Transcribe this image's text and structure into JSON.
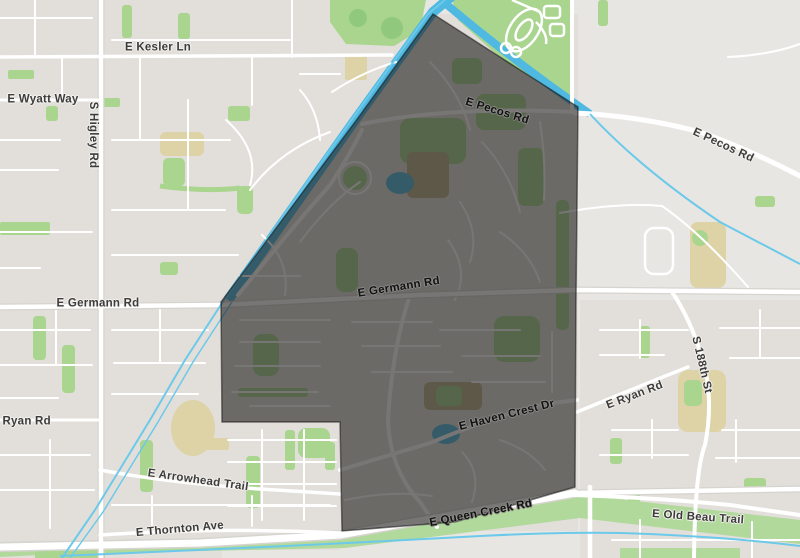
{
  "map": {
    "description": "Street map with a dark highlighted neighborhood boundary region",
    "colors": {
      "land": "#e8e6e2",
      "block": "#e2dfda",
      "road": "#ffffff",
      "road_casing": "#d6d4cf",
      "park_green": "#a9d58f",
      "park_green_dark": "#90c97e",
      "corridor_green": "#b0d99b",
      "water_blue": "#5ec3e9",
      "channel_blue": "#4fb9e2",
      "tan": "#ddd3a6",
      "label_outside": "#3c3c3c",
      "label_inside": "#121212"
    },
    "highlight_region": {
      "name": "selected neighborhood boundary",
      "polygon_px": "433,14 578,107 576,300 575,487 455,522 342,531 340,422 222,422 221,302 358,118",
      "fill": "rgba(35,34,33,0.62)",
      "stroke": "rgba(10,10,10,0.5)"
    },
    "road_labels": [
      {
        "text": "E Kesler Ln",
        "x": 158,
        "y": 48,
        "rot": 0,
        "style": "outside"
      },
      {
        "text": "E Wyatt Way",
        "x": 43,
        "y": 100,
        "rot": 0,
        "style": "outside"
      },
      {
        "text": "S Higley Rd",
        "x": 92,
        "y": 135,
        "rot": 90,
        "style": "outside"
      },
      {
        "text": "E Pecos Rd",
        "x": 497,
        "y": 112,
        "rot": 17,
        "style": "inside"
      },
      {
        "text": "E Pecos Rd",
        "x": 723,
        "y": 146,
        "rot": 25,
        "style": "outside"
      },
      {
        "text": "E Germann Rd",
        "x": 98,
        "y": 304,
        "rot": 0,
        "style": "outside"
      },
      {
        "text": "E Germann Rd",
        "x": 399,
        "y": 288,
        "rot": -9,
        "style": "inside"
      },
      {
        "text": "S 188th St",
        "x": 701,
        "y": 365,
        "rot": 77,
        "style": "outside"
      },
      {
        "text": "E Ryan Rd",
        "x": 21,
        "y": 422,
        "rot": 0,
        "style": "outside"
      },
      {
        "text": "E Ryan Rd",
        "x": 635,
        "y": 396,
        "rot": -21,
        "style": "outside"
      },
      {
        "text": "E Haven Crest Dr",
        "x": 507,
        "y": 416,
        "rot": -14,
        "style": "inside"
      },
      {
        "text": "E Arrowhead Trail",
        "x": 198,
        "y": 481,
        "rot": 8,
        "style": "outside"
      },
      {
        "text": "E Thornton Ave",
        "x": 180,
        "y": 530,
        "rot": -5,
        "style": "outside"
      },
      {
        "text": "E Queen Creek Rd",
        "x": 481,
        "y": 514,
        "rot": -11,
        "style": "inside"
      },
      {
        "text": "E Old Beau Trail",
        "x": 698,
        "y": 518,
        "rot": 4,
        "style": "outside"
      }
    ]
  }
}
